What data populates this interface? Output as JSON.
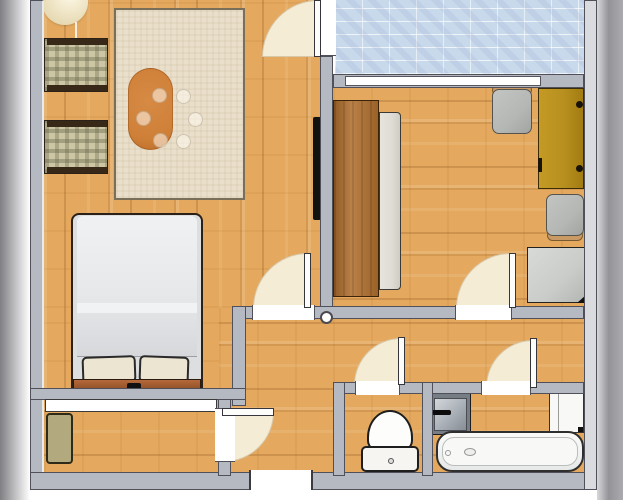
{
  "scene": {
    "title": "apartment-floor-plan",
    "style": "top-down 2D rendered floor plan, no text labels",
    "view": "orthographic top view with page drop shadows left and right"
  },
  "colors": {
    "wall": "#b5bac2",
    "wall-edge": "#50505a",
    "wall-light": "#dadbde",
    "wood": "#e4a95f",
    "balcony": "#c9d9ec",
    "arc": "#f5ecd6",
    "leaf": "#fcfcfa",
    "rug": "#e9dfca",
    "rug-edge": "#7a6f58",
    "table": "#cf8038",
    "plaid": "#ccc6a4",
    "arm": "#372818",
    "duvet-a": "#eff1f3",
    "duvet-b": "#d6d8db",
    "pillow": "#ece5d2",
    "headboard-a": "#b5693a",
    "headboard-b": "#8a4c24",
    "outline": "#2b2119",
    "wardrobe": "#b06f2e",
    "panel": "#dedcd4",
    "desk": "#b8901f",
    "desk-edge": "#3a2c08",
    "chair": "#b5b7b5",
    "chair-wood": "#c99a63",
    "dresser": "#caccc9",
    "doormat": "#b3a97e",
    "tv": "#141210",
    "lamp-a": "#fdf8e6",
    "lamp-b": "#e6d9b2",
    "sink-outer": "#767d85",
    "sink-inner": "#a9afb6",
    "white-fix": "#f8f9f7",
    "shadow-a": "#7f7f84",
    "shadow-b": "#939398"
  },
  "rooms": [
    {
      "name": "living-room",
      "floor": "wood vertical planks",
      "furniture": [
        "pendant-lamp",
        "armchair-1",
        "armchair-2",
        "area-rug",
        "oval-dining-table",
        "six-translucent-seats",
        "wall-tv",
        "double-bed-with-two-pillows"
      ]
    },
    {
      "name": "balcony",
      "floor": "light-blue tile"
    },
    {
      "name": "office-bedroom",
      "floor": "wood horizontal planks",
      "furniture": [
        "wardrobe",
        "wardrobe-panel",
        "desk-cabinet",
        "desk-chair-1",
        "desk-chair-2",
        "dresser"
      ]
    },
    {
      "name": "hallway",
      "floor": "wood horizontal planks",
      "furniture": [
        "hinge-column-dot"
      ]
    },
    {
      "name": "entry-corridor",
      "floor": "wood horizontal planks",
      "furniture": [
        "doormat",
        "closet-strip"
      ]
    },
    {
      "name": "wc",
      "floor": "wood",
      "furniture": [
        "toilet"
      ]
    },
    {
      "name": "bathroom",
      "floor": "wood",
      "furniture": [
        "washbasin",
        "wall-cabinet",
        "bathtub"
      ]
    }
  ],
  "doors": [
    "balcony-door",
    "living-room-door",
    "office-door",
    "wc-door",
    "bathroom-door",
    "entry-corridor-door",
    "front-door-opening"
  ],
  "windows": [
    "balcony-window-strip"
  ]
}
